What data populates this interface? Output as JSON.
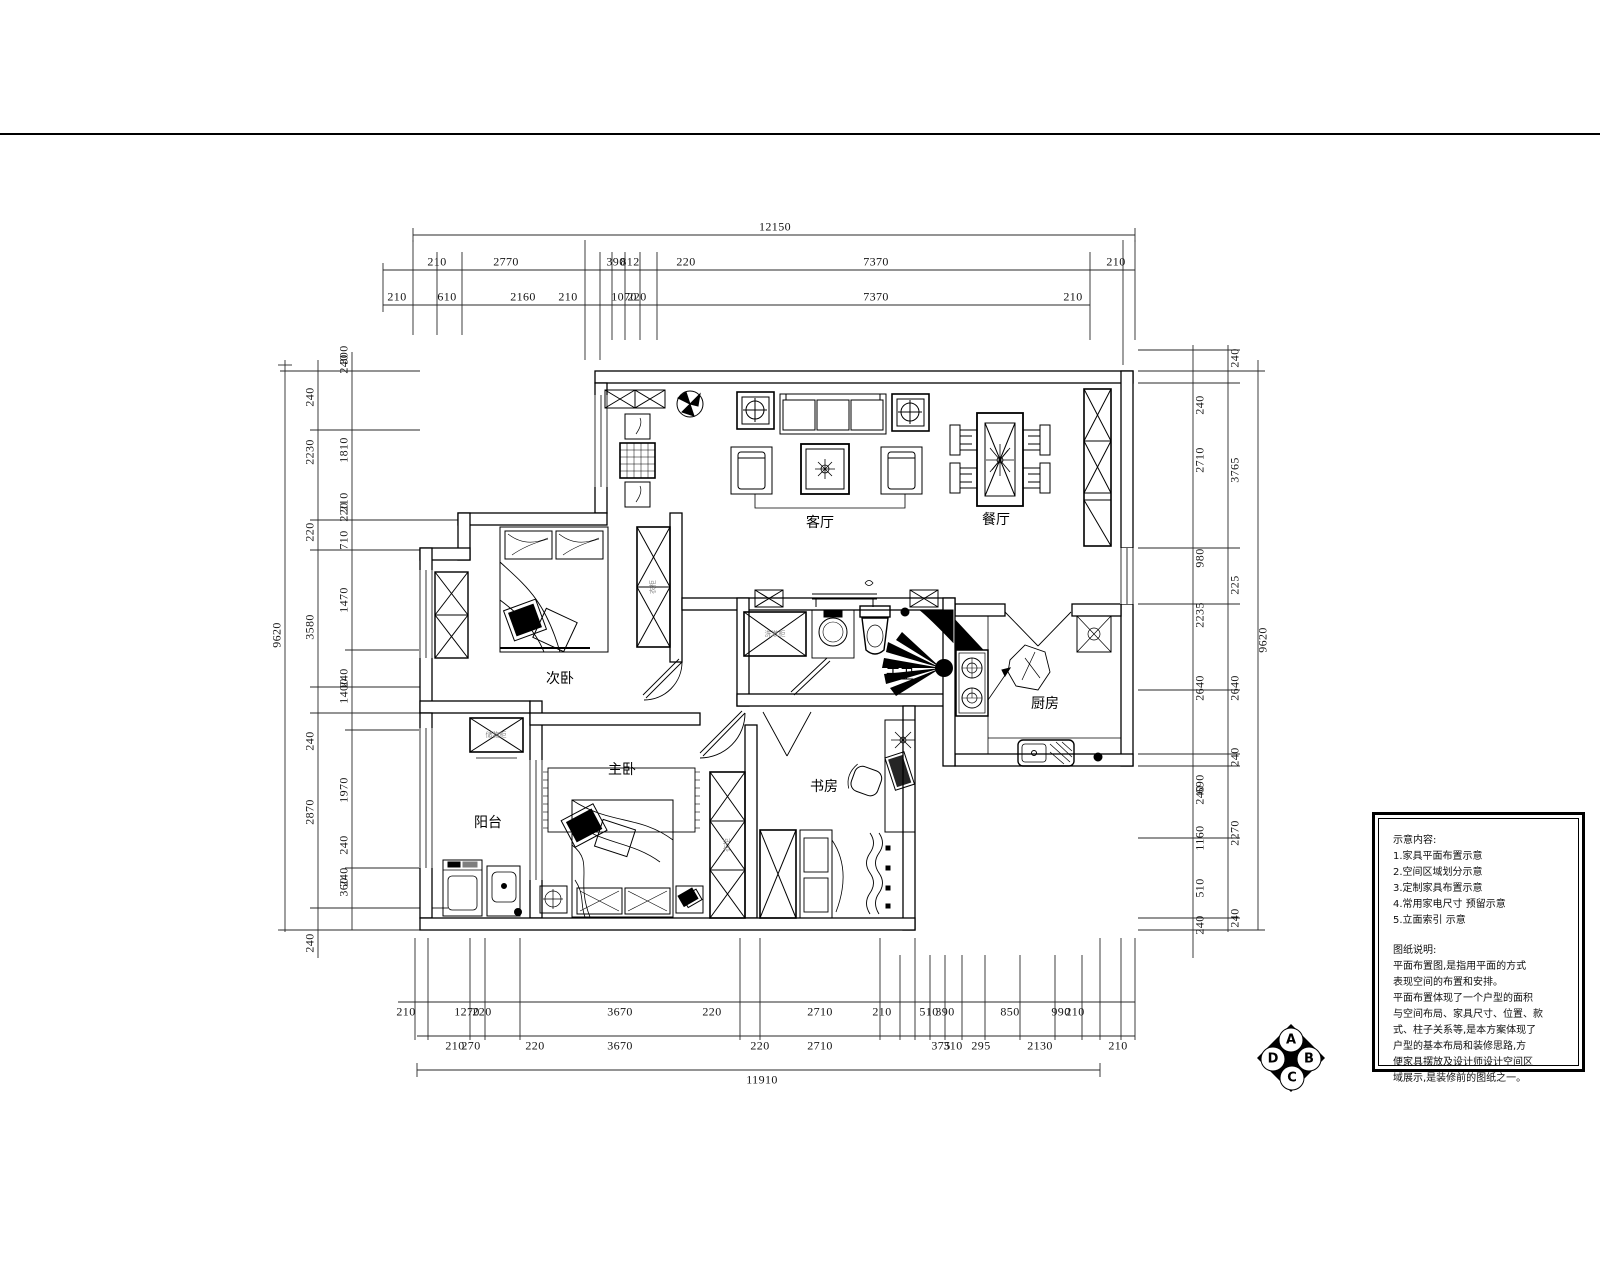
{
  "rooms": {
    "living": "客厅",
    "dining": "餐厅",
    "bed2": "次卧",
    "master": "主卧",
    "balcony": "阳台",
    "study": "书房",
    "bath": "干卫",
    "kitchen": "厨房"
  },
  "furniture_labels": {
    "vanity": "洗漱柜",
    "wardrobe": "衣柜",
    "wardrobe2": "衣柜",
    "cabinet": "储物柜"
  },
  "dims": {
    "totals": {
      "top": "12150",
      "bottom": "11910",
      "left": "9620",
      "right": "9620"
    },
    "top1": [
      "210",
      "2770",
      "390",
      "812",
      "220",
      "7370",
      "210"
    ],
    "top2": [
      "210",
      "610",
      "2160",
      "210",
      "1070",
      "220",
      "7370",
      "210"
    ],
    "bottom1": [
      "210",
      "1270",
      "220",
      "3670",
      "220",
      "2710",
      "210",
      "510",
      "390",
      "850",
      "990",
      "210"
    ],
    "bottom2": [
      "210",
      "270",
      "220",
      "3670",
      "220",
      "2710",
      "375",
      "310",
      "295",
      "2130",
      "210"
    ],
    "left_mid": [
      "240",
      "2230",
      "220",
      "3580",
      "240",
      "2870",
      "240"
    ],
    "left_in": [
      "300",
      "240",
      "1810",
      "210",
      "220",
      "710",
      "1470",
      "240",
      "1400",
      "1970",
      "240",
      "240",
      "360"
    ],
    "right_in": [
      "240",
      "2710",
      "980",
      "2235",
      "2640",
      "690",
      "240",
      "1160",
      "510",
      "240"
    ],
    "right_out": [
      "240",
      "3765",
      "225",
      "2640",
      "240",
      "2270",
      "240"
    ]
  },
  "notes": {
    "head": "示意内容:",
    "items": [
      "1.家具平面布置示意",
      "2.空间区域划分示意",
      "3.定制家具布置示意",
      "4.常用家电尺寸 预留示意",
      "5.立面索引 示意"
    ],
    "head2": "图纸说明:",
    "body": [
      "平面布置图,是指用平面的方式",
      "表现空间的布置和安排。",
      "平面布置体现了一个户型的面积",
      "与空间布局、家具尺寸、位置、款",
      "式、柱子关系等,是本方案体现了",
      "户型的基本布局和装修思路,方",
      "便家具摆放及设计师设计空间区",
      "域展示,是装修前的图纸之一。"
    ]
  },
  "elevation_symbol": {
    "a": "A",
    "b": "B",
    "c": "C",
    "d": "D"
  }
}
